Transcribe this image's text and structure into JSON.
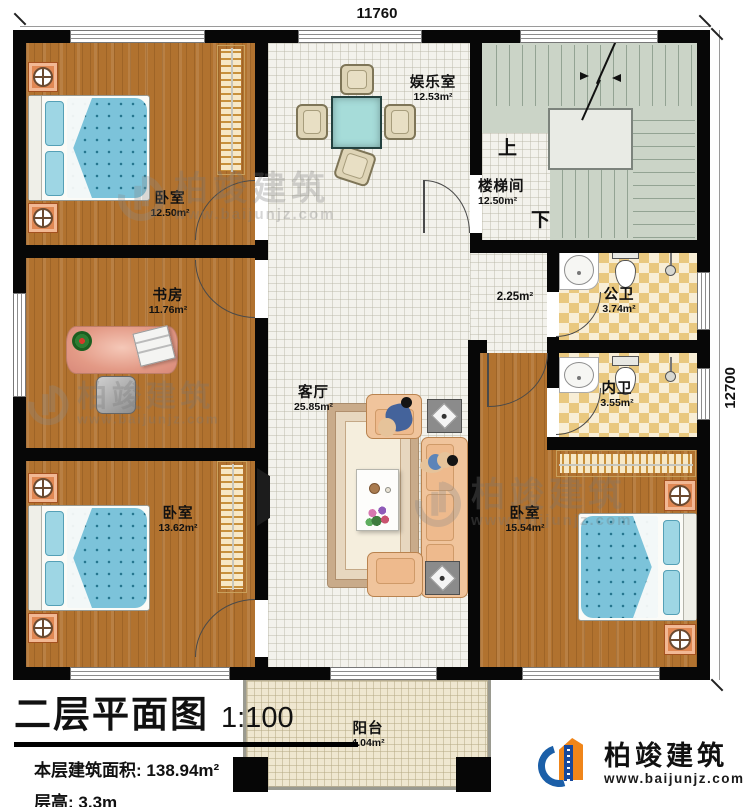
{
  "dimensions": {
    "top": "11760",
    "right": "12700"
  },
  "rooms": {
    "bedroom_tl": {
      "name": "卧室",
      "area": "12.50m²"
    },
    "study": {
      "name": "书房",
      "area": "11.76m²"
    },
    "bedroom_bl": {
      "name": "卧室",
      "area": "13.62m²"
    },
    "entertainment": {
      "name": "娱乐室",
      "area": "12.53m²"
    },
    "living": {
      "name": "客厅",
      "area": "25.85m²"
    },
    "stairwell": {
      "name": "楼梯间",
      "area": "12.50m²"
    },
    "corridor": {
      "area": "2.25m²"
    },
    "bath_public": {
      "name": "公卫",
      "area": "3.74m²"
    },
    "bath_ensuite": {
      "name": "内卫",
      "area": "3.55m²"
    },
    "bedroom_r": {
      "name": "卧室",
      "area": "15.54m²"
    },
    "balcony": {
      "name": "阳台",
      "area": "4.04m²"
    }
  },
  "stairs": {
    "up": "上",
    "down": "下"
  },
  "title_block": {
    "plan_title": "二层平面图",
    "scale": "1:100",
    "area_label": "本层建筑面积:",
    "area_value": "138.94m²",
    "height_label": "层高:",
    "height_value": "3.3m"
  },
  "watermark": {
    "name": "柏竣建筑",
    "url": "www.baijunjz.com"
  },
  "logo": {
    "name": "柏竣建筑",
    "url": "www.baijunjz.com"
  },
  "colors": {
    "wall": "#070707",
    "wood_floor": "#b1722f",
    "tile_floor": "#f3f2ec",
    "stair_floor": "#cbd4c7",
    "checker_dark": "#e9c87f",
    "checker_light": "#f8eed6",
    "balcony_floor": "#efe7d0",
    "bed_blue": "#7cc3da",
    "sofa_peach": "#f0c49c",
    "nightstand_orange": "#e08854",
    "wardrobe_cream": "#f7e8c6",
    "game_table_teal": "#a6dcd9",
    "desk_salmon": "#e39a86",
    "logo_blue": "#1b5fa8",
    "logo_orange": "#f08519"
  }
}
